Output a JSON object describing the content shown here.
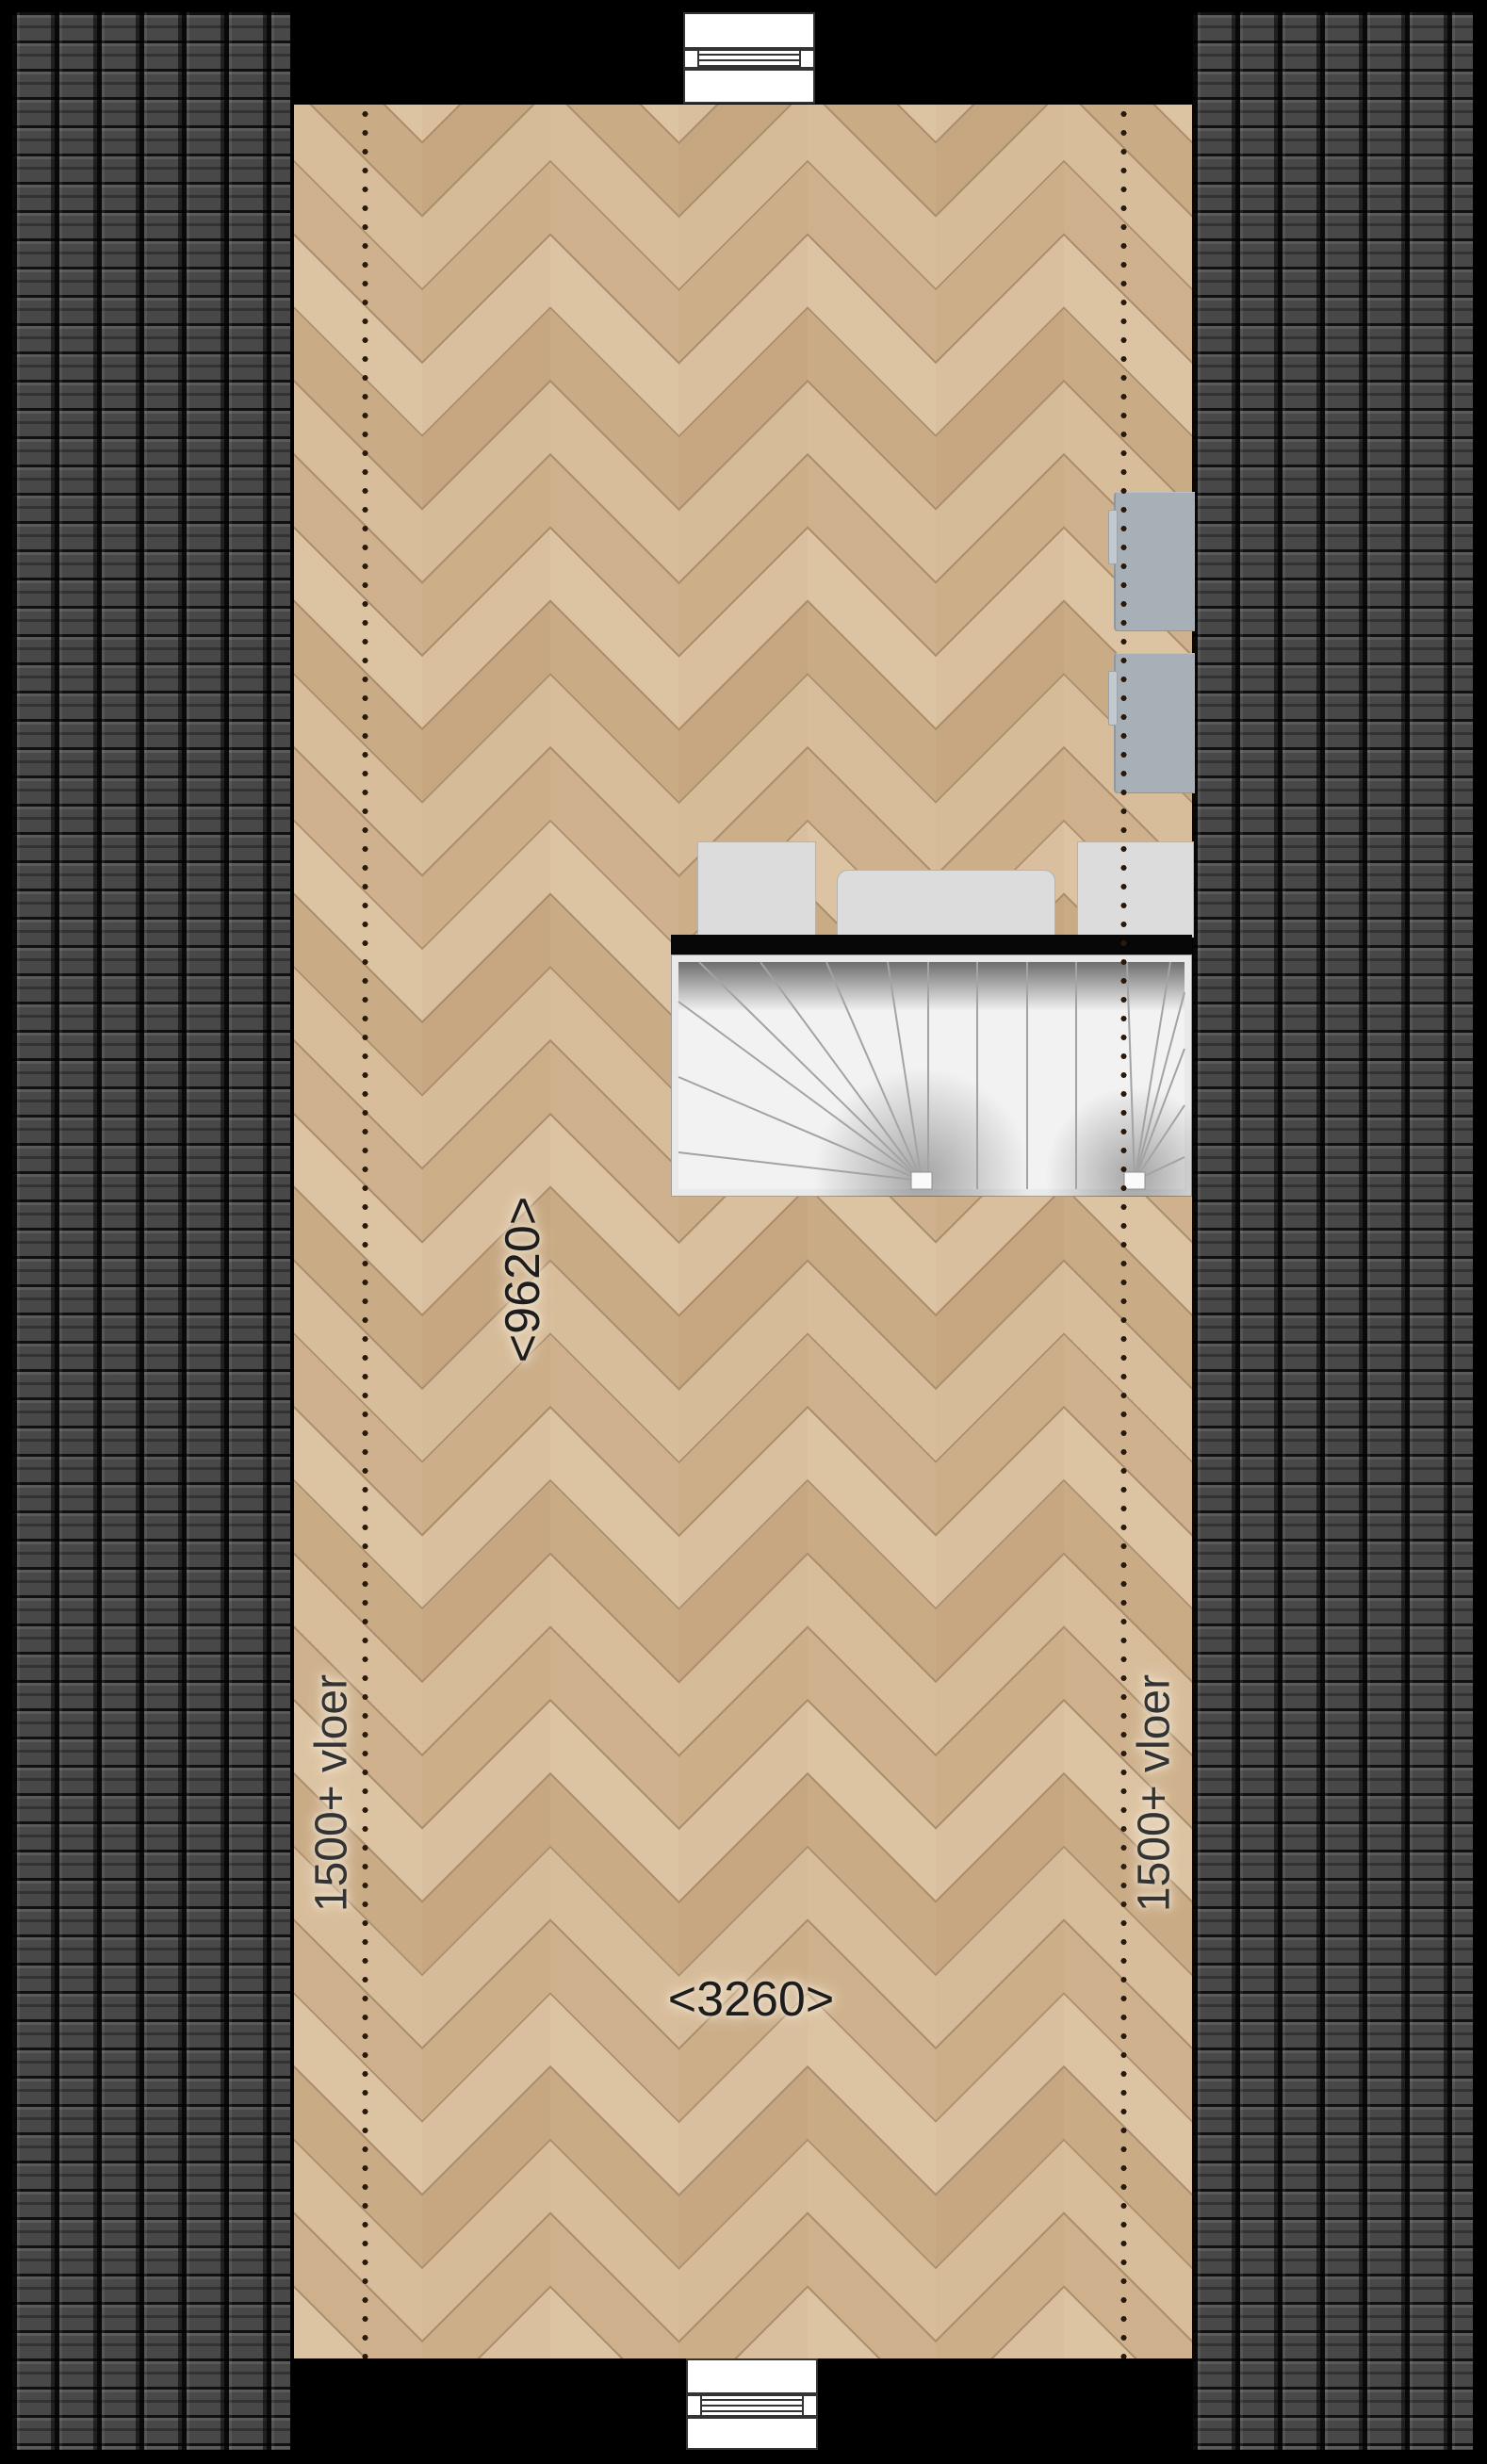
{
  "title": "attic-floor-plan",
  "labels": {
    "dim_vertical": "<9620>",
    "dim_horizontal": "<3260>",
    "floor_note_left": "1500+ vloer",
    "floor_note_right": "1500+ vloer"
  },
  "colors": {
    "background": "#000000",
    "roof_tile": "#484848",
    "roof_gap": "#0d0d0d",
    "floor_wood_light": "#dcc3a1",
    "floor_wood_dark": "#c9ab85",
    "wall_band": "#070707",
    "stair_tread": "#f2f2f2",
    "radiator": "#a7afb7",
    "cabinet": "#dcdcdc",
    "dotted_line": "#2a1a0d",
    "window_frame": "#333333",
    "label_text": "#1d1d1d"
  },
  "legend": {
    "dotted_line_meaning": "1500+ vloer",
    "window_symbol": "louvered-window"
  }
}
